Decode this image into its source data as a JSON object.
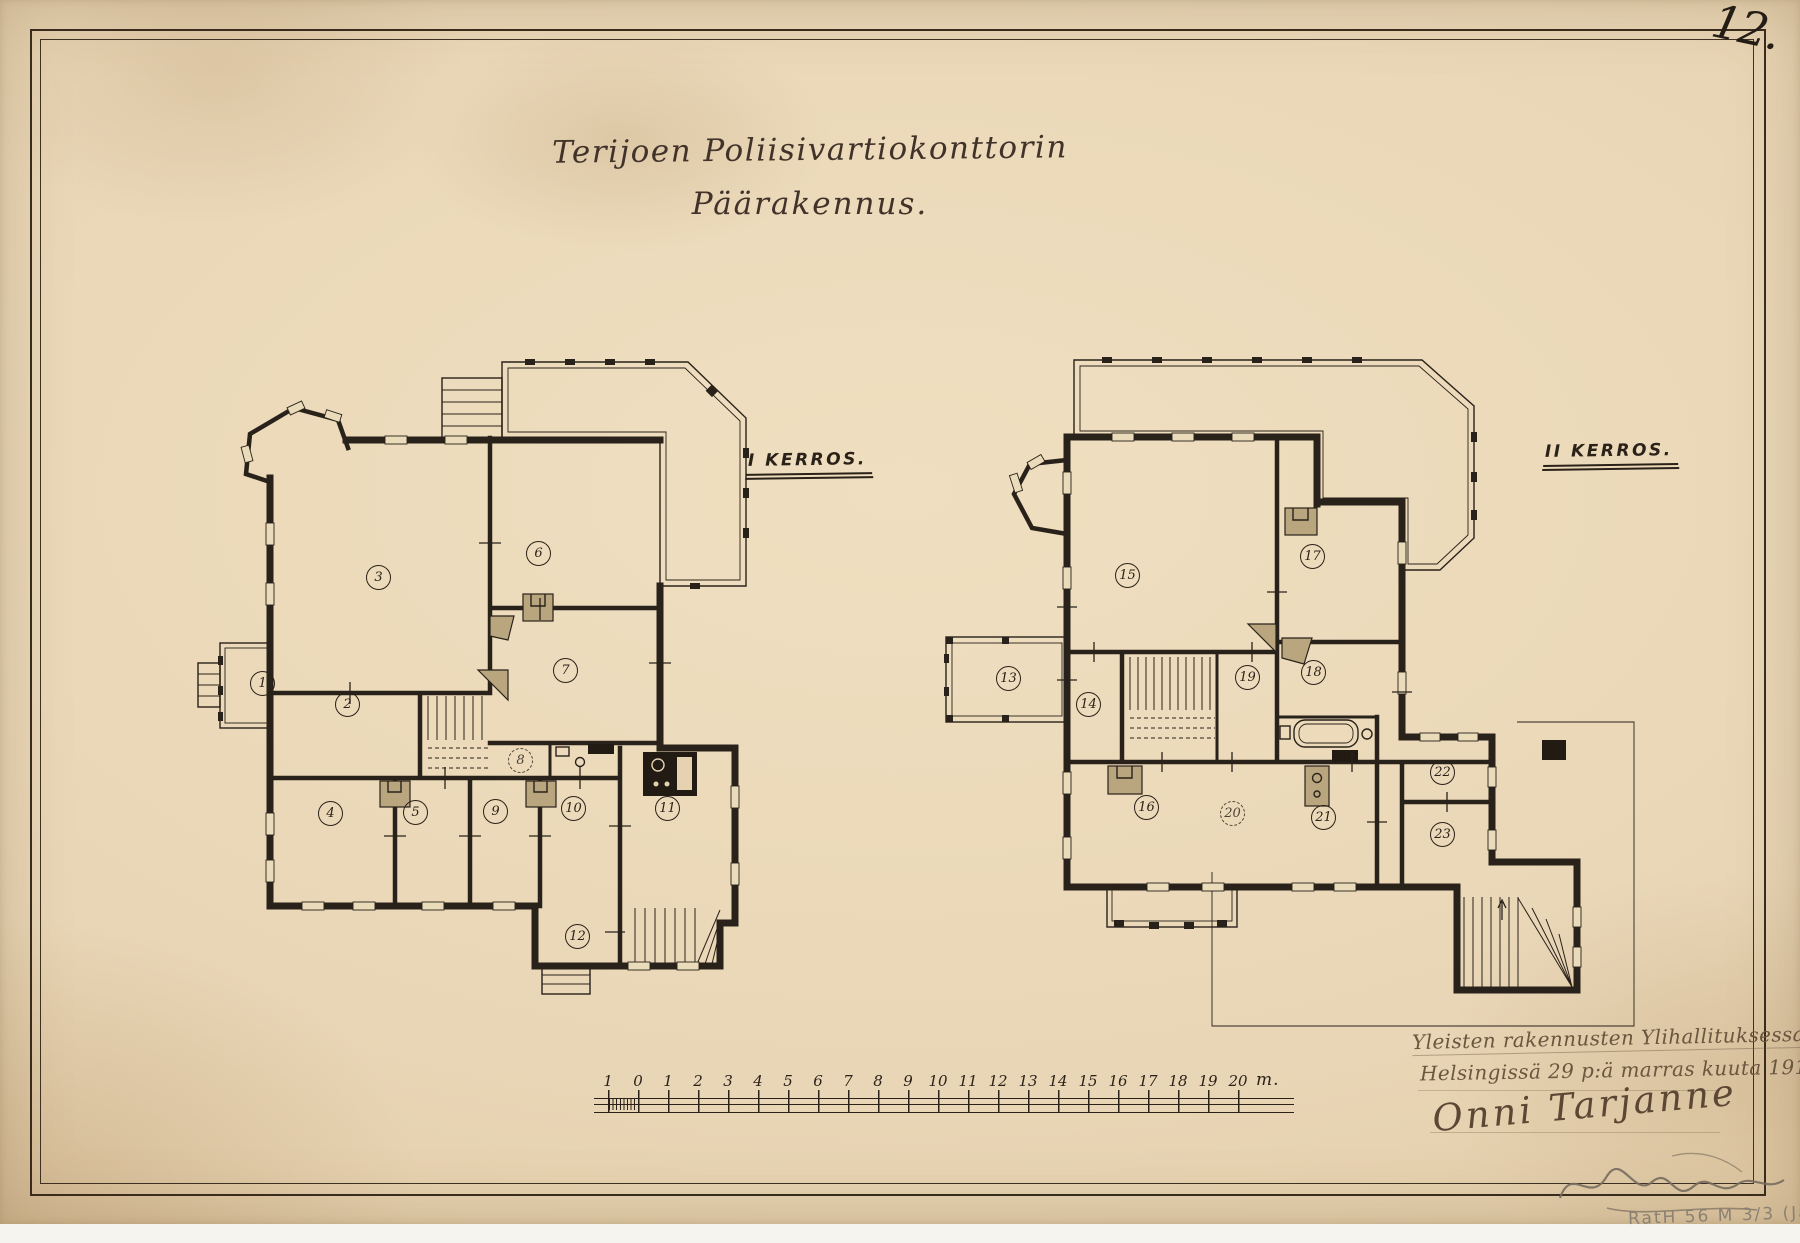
{
  "page": {
    "number": "12.",
    "title_line1": "Terijoen Poliisivartiokonttorin",
    "title_line2": "Päärakennus."
  },
  "floors": [
    {
      "id": "floor1",
      "label": "I Kerros.",
      "rooms": [
        {
          "n": "1",
          "x": 72,
          "y": 335
        },
        {
          "n": "2",
          "x": 157,
          "y": 356
        },
        {
          "n": "3",
          "x": 188,
          "y": 229
        },
        {
          "n": "4",
          "x": 140,
          "y": 465
        },
        {
          "n": "5",
          "x": 225,
          "y": 464
        },
        {
          "n": "6",
          "x": 348,
          "y": 205
        },
        {
          "n": "7",
          "x": 375,
          "y": 322
        },
        {
          "n": "8",
          "x": 330,
          "y": 412,
          "dashed": true
        },
        {
          "n": "9",
          "x": 305,
          "y": 463
        },
        {
          "n": "10",
          "x": 383,
          "y": 460
        },
        {
          "n": "11",
          "x": 477,
          "y": 460
        },
        {
          "n": "12",
          "x": 387,
          "y": 588
        }
      ]
    },
    {
      "id": "floor2",
      "label": "II Kerros.",
      "rooms": [
        {
          "n": "13",
          "x": 146,
          "y": 336
        },
        {
          "n": "14",
          "x": 226,
          "y": 362
        },
        {
          "n": "15",
          "x": 265,
          "y": 233
        },
        {
          "n": "16",
          "x": 284,
          "y": 465
        },
        {
          "n": "17",
          "x": 450,
          "y": 214
        },
        {
          "n": "18",
          "x": 451,
          "y": 330
        },
        {
          "n": "19",
          "x": 385,
          "y": 335
        },
        {
          "n": "20",
          "x": 370,
          "y": 471,
          "dashed": true
        },
        {
          "n": "21",
          "x": 461,
          "y": 475
        },
        {
          "n": "22",
          "x": 580,
          "y": 430
        },
        {
          "n": "23",
          "x": 580,
          "y": 492
        }
      ]
    }
  ],
  "scale_bar": {
    "labels": [
      "1",
      "0",
      "1",
      "2",
      "3",
      "4",
      "5",
      "6",
      "7",
      "8",
      "9",
      "10",
      "11",
      "12",
      "13",
      "14",
      "15",
      "16",
      "17",
      "18",
      "19",
      "20"
    ],
    "unit": "m."
  },
  "inscription": {
    "office_line": "Yleisten rakennusten Ylihallituksessa",
    "date_line": "Helsingissä 29 p:ä marras kuuta 1914",
    "signature": "Onni Tarjanne"
  },
  "pencil_note": "RatH 56 M 3/3 (Ja",
  "colors": {
    "paper": "#e9d6b6",
    "ink": "#2a2118",
    "hand_ink": "#6b563f",
    "pencil": "#8b8173",
    "stove_fill": "#b9a67f"
  }
}
